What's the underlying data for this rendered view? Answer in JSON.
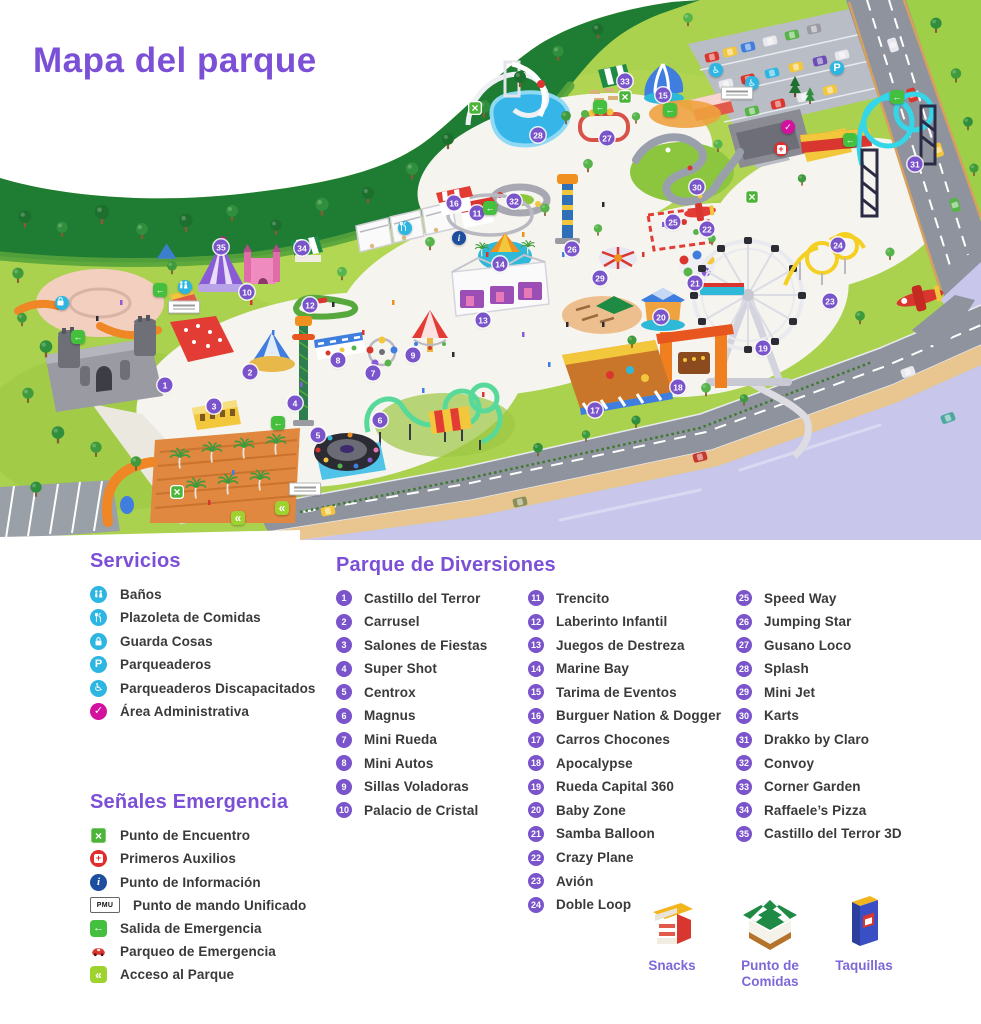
{
  "title": "Mapa del parque",
  "colors": {
    "accent_purple": "#7b4fd6",
    "badge_purple": "#7a54cb",
    "service_cyan": "#2eb6e3",
    "admin_magenta": "#d4119e",
    "emergency_green": "#4db43a",
    "access_lime": "#9ed32f",
    "alert_red": "#e02d2d",
    "info_blue": "#1d4f9e"
  },
  "legend": {
    "servicios": {
      "heading": "Servicios",
      "items": [
        {
          "icon": "banos",
          "label": "Baños"
        },
        {
          "icon": "comidas",
          "label": "Plazoleta de Comidas"
        },
        {
          "icon": "guarda",
          "label": "Guarda Cosas"
        },
        {
          "icon": "parqueadero",
          "label": "Parqueaderos"
        },
        {
          "icon": "discapacitados",
          "label": "Parqueaderos Discapacitados"
        },
        {
          "icon": "admin",
          "label": "Área Administrativa"
        }
      ]
    },
    "emergencia": {
      "heading": "Señales Emergencia",
      "items": [
        {
          "icon": "encuentro",
          "label": "Punto de Encuentro"
        },
        {
          "icon": "auxilios",
          "label": "Primeros Auxilios"
        },
        {
          "icon": "informacion",
          "label": "Punto de Información"
        },
        {
          "icon": "pmu",
          "label": "Punto de mando Unificado"
        },
        {
          "icon": "salida",
          "label": "Salida de Emergencia"
        },
        {
          "icon": "parqueo_emergencia",
          "label": "Parqueo de Emergencia"
        },
        {
          "icon": "acceso",
          "label": "Acceso al Parque"
        }
      ]
    },
    "atracciones": {
      "heading": "Parque de Diversiones",
      "columns": [
        [
          {
            "n": 1,
            "label": "Castillo del Terror"
          },
          {
            "n": 2,
            "label": "Carrusel"
          },
          {
            "n": 3,
            "label": "Salones de Fiestas"
          },
          {
            "n": 4,
            "label": "Super Shot"
          },
          {
            "n": 5,
            "label": "Centrox"
          },
          {
            "n": 6,
            "label": "Magnus"
          },
          {
            "n": 7,
            "label": "Mini Rueda"
          },
          {
            "n": 8,
            "label": "Mini Autos"
          },
          {
            "n": 9,
            "label": "Sillas Voladoras"
          },
          {
            "n": 10,
            "label": "Palacio de Cristal"
          }
        ],
        [
          {
            "n": 11,
            "label": "Trencito"
          },
          {
            "n": 12,
            "label": "Laberinto Infantil"
          },
          {
            "n": 13,
            "label": "Juegos de Destreza"
          },
          {
            "n": 14,
            "label": "Marine Bay"
          },
          {
            "n": 15,
            "label": "Tarima de Eventos"
          },
          {
            "n": 16,
            "label": "Burguer Nation & Dogger"
          },
          {
            "n": 17,
            "label": "Carros Chocones"
          },
          {
            "n": 18,
            "label": "Apocalypse"
          },
          {
            "n": 19,
            "label": "Rueda Capital 360"
          },
          {
            "n": 20,
            "label": "Baby Zone"
          },
          {
            "n": 21,
            "label": "Samba Balloon"
          },
          {
            "n": 22,
            "label": "Crazy Plane"
          },
          {
            "n": 23,
            "label": "Avión"
          },
          {
            "n": 24,
            "label": "Doble Loop"
          }
        ],
        [
          {
            "n": 25,
            "label": "Speed Way"
          },
          {
            "n": 26,
            "label": "Jumping Star"
          },
          {
            "n": 27,
            "label": "Gusano Loco"
          },
          {
            "n": 28,
            "label": "Splash"
          },
          {
            "n": 29,
            "label": "Mini Jet"
          },
          {
            "n": 30,
            "label": "Karts"
          },
          {
            "n": 31,
            "label": "Drakko by Claro"
          },
          {
            "n": 32,
            "label": "Convoy"
          },
          {
            "n": 33,
            "label": "Corner Garden"
          },
          {
            "n": 34,
            "label": "Raffaele’s Pizza"
          },
          {
            "n": 35,
            "label": "Castillo del Terror 3D"
          }
        ]
      ]
    },
    "kioskos": [
      {
        "icon": "snacks",
        "label": "Snacks"
      },
      {
        "icon": "punto_comidas",
        "label": "Punto de Comidas"
      },
      {
        "icon": "taquillas",
        "label": "Taquillas"
      }
    ]
  },
  "map": {
    "markers": [
      {
        "n": 1,
        "x": 165,
        "y": 385
      },
      {
        "n": 2,
        "x": 250,
        "y": 372
      },
      {
        "n": 3,
        "x": 214,
        "y": 406
      },
      {
        "n": 4,
        "x": 295,
        "y": 403
      },
      {
        "n": 5,
        "x": 318,
        "y": 435
      },
      {
        "n": 6,
        "x": 380,
        "y": 420
      },
      {
        "n": 7,
        "x": 373,
        "y": 373
      },
      {
        "n": 8,
        "x": 338,
        "y": 360
      },
      {
        "n": 9,
        "x": 413,
        "y": 355
      },
      {
        "n": 10,
        "x": 247,
        "y": 292
      },
      {
        "n": 11,
        "x": 477,
        "y": 213
      },
      {
        "n": 12,
        "x": 310,
        "y": 305
      },
      {
        "n": 13,
        "x": 483,
        "y": 320
      },
      {
        "n": 14,
        "x": 500,
        "y": 264
      },
      {
        "n": 15,
        "x": 663,
        "y": 95
      },
      {
        "n": 16,
        "x": 454,
        "y": 203
      },
      {
        "n": 17,
        "x": 595,
        "y": 410
      },
      {
        "n": 18,
        "x": 678,
        "y": 387
      },
      {
        "n": 19,
        "x": 763,
        "y": 348
      },
      {
        "n": 20,
        "x": 661,
        "y": 317
      },
      {
        "n": 21,
        "x": 695,
        "y": 283
      },
      {
        "n": 22,
        "x": 707,
        "y": 229
      },
      {
        "n": 23,
        "x": 830,
        "y": 301
      },
      {
        "n": 24,
        "x": 838,
        "y": 245
      },
      {
        "n": 25,
        "x": 673,
        "y": 222
      },
      {
        "n": 26,
        "x": 572,
        "y": 249
      },
      {
        "n": 27,
        "x": 607,
        "y": 138
      },
      {
        "n": 28,
        "x": 538,
        "y": 135
      },
      {
        "n": 29,
        "x": 600,
        "y": 278
      },
      {
        "n": 30,
        "x": 697,
        "y": 187
      },
      {
        "n": 31,
        "x": 915,
        "y": 164
      },
      {
        "n": 32,
        "x": 514,
        "y": 201
      },
      {
        "n": 33,
        "x": 625,
        "y": 81
      },
      {
        "n": 34,
        "x": 302,
        "y": 248
      },
      {
        "n": 35,
        "x": 221,
        "y": 247
      }
    ],
    "service_markers": [
      {
        "type": "comidas",
        "x": 405,
        "y": 228
      },
      {
        "type": "informacion",
        "x": 459,
        "y": 238
      },
      {
        "type": "banos",
        "x": 185,
        "y": 287
      },
      {
        "type": "guarda",
        "x": 62,
        "y": 303
      },
      {
        "type": "parqueadero",
        "x": 837,
        "y": 68
      },
      {
        "type": "discapacitados",
        "x": 716,
        "y": 70
      },
      {
        "type": "discapacitados",
        "x": 752,
        "y": 83
      },
      {
        "type": "admin",
        "x": 788,
        "y": 127
      },
      {
        "type": "auxilios",
        "x": 781,
        "y": 149
      },
      {
        "type": "encuentro",
        "x": 475,
        "y": 108
      },
      {
        "type": "encuentro",
        "x": 625,
        "y": 97
      },
      {
        "type": "encuentro",
        "x": 752,
        "y": 197
      },
      {
        "type": "encuentro",
        "x": 177,
        "y": 492
      },
      {
        "type": "salida",
        "x": 600,
        "y": 107
      },
      {
        "type": "salida",
        "x": 670,
        "y": 110
      },
      {
        "type": "salida",
        "x": 897,
        "y": 97
      },
      {
        "type": "salida",
        "x": 850,
        "y": 140
      },
      {
        "type": "salida",
        "x": 490,
        "y": 208
      },
      {
        "type": "salida",
        "x": 160,
        "y": 290
      },
      {
        "type": "salida",
        "x": 78,
        "y": 337
      },
      {
        "type": "salida",
        "x": 278,
        "y": 423
      },
      {
        "type": "acceso",
        "x": 238,
        "y": 518
      },
      {
        "type": "acceso",
        "x": 282,
        "y": 508
      },
      {
        "type": "sign",
        "x": 737,
        "y": 93
      },
      {
        "type": "sign",
        "x": 184,
        "y": 307
      },
      {
        "type": "sign",
        "x": 305,
        "y": 489
      }
    ]
  }
}
